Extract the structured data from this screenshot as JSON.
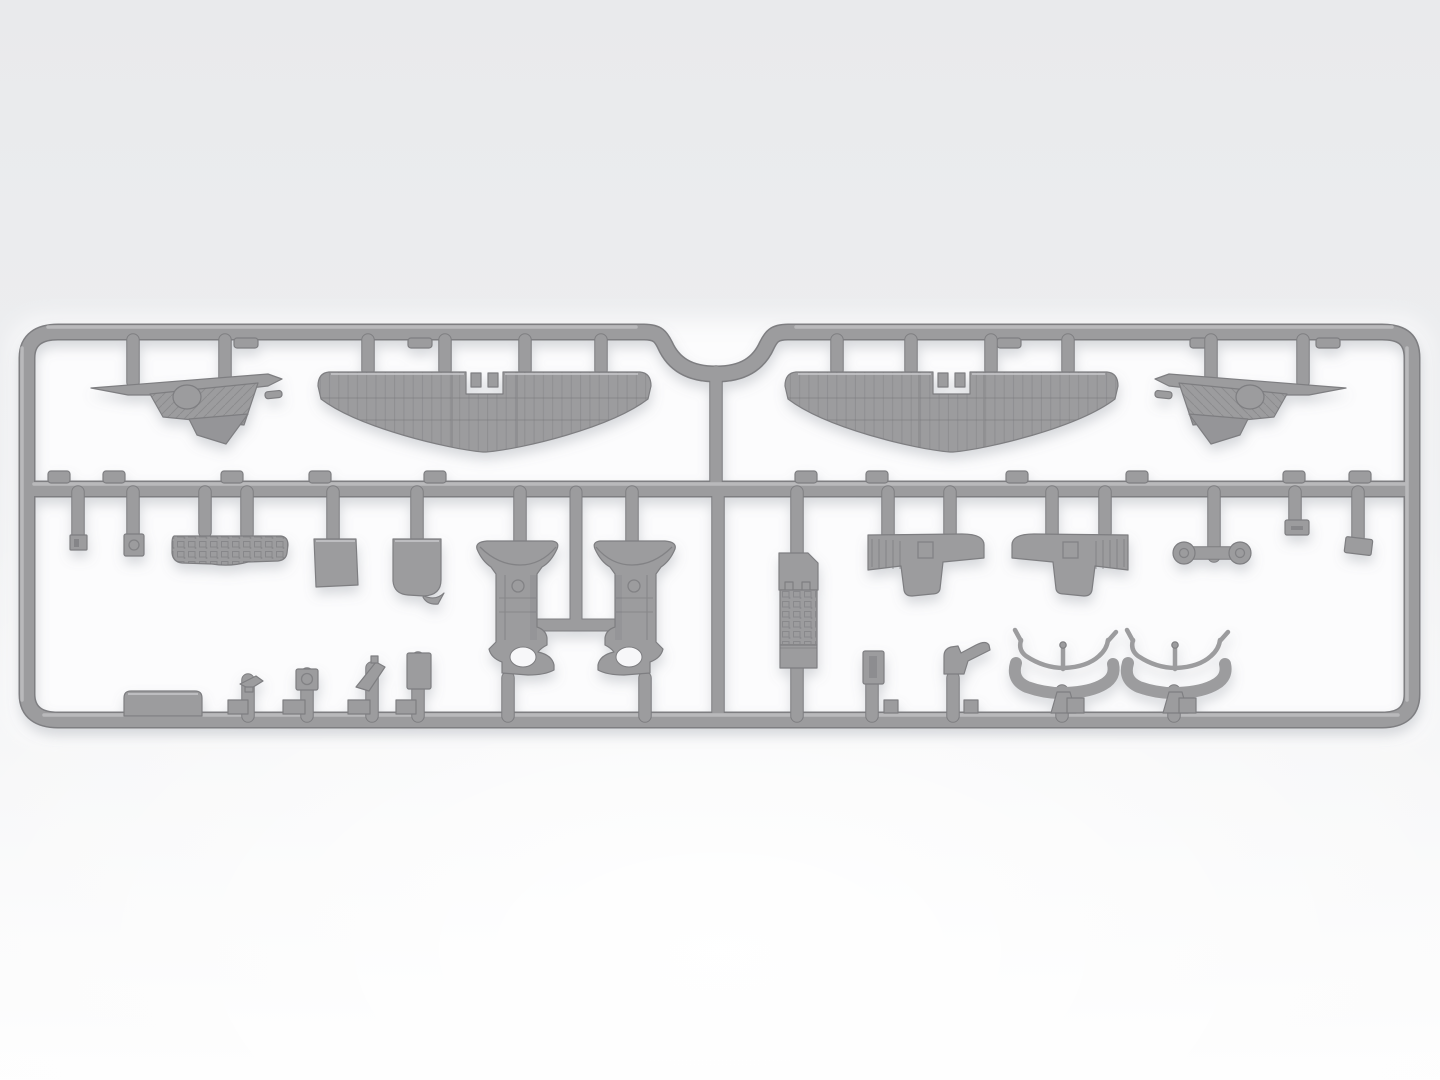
{
  "scene": {
    "type": "product-render",
    "subject": "Gray injection-molded plastic sprue (parts frame) of a scale model aircraft kit, viewed top-down",
    "background": "soft light-gray studio gradient, brighter toward the bottom",
    "text_content": "none"
  },
  "colors": {
    "plastic": "#9c9c9e",
    "plasticDark": "#7e7e81",
    "plasticLight": "#c6c6c8",
    "detailDark": "#77777a",
    "holeFill": "#f7f7f9",
    "innerGlow": "#fcfcfd",
    "bgTop": "#e9eaec",
    "bgMid": "#edeef0",
    "bgBottom": "#fdfdfd",
    "shadow": "#7e8490"
  },
  "sprue": {
    "shape": "wide rounded-rectangle frame with a semicircular notch at top center, one horizontal middle rail, and a vertical center divider",
    "rows": 2,
    "halves": 2,
    "attachment_stubs": {
      "top_rail": 12,
      "middle_rail": 16,
      "bottom_rail": 11
    }
  },
  "parts": [
    {
      "name": "stabilizer-half-left",
      "description": "Tailplane/elevator half with ribbed surface and round balance bump",
      "area": "top row, far left"
    },
    {
      "name": "lower-wing-left",
      "description": "One-piece corrugated lower wing with central fuselage notch",
      "area": "top row, left of center"
    },
    {
      "name": "lower-wing-right",
      "description": "Mirrored one-piece corrugated lower wing with central fuselage notch",
      "area": "top row, right of center"
    },
    {
      "name": "stabilizer-half-right",
      "description": "Mirrored tailplane/elevator half",
      "area": "top row, far right"
    },
    {
      "name": "small-fitting-plate",
      "description": "Tiny square fitting with slot",
      "area": "middle row, far left"
    },
    {
      "name": "bracket-with-hole",
      "description": "Small rectangular bracket with round opening",
      "area": "middle row, left"
    },
    {
      "name": "instrument-panel",
      "description": "Long cockpit instrument panel with engraved dial detail",
      "area": "middle row, left"
    },
    {
      "name": "access-hatch-plate",
      "description": "Flat square hatch plate",
      "area": "middle row, left-center"
    },
    {
      "name": "seat-back-plate",
      "description": "Plate with rounded lower corners",
      "area": "middle row, left-center"
    },
    {
      "name": "cowling-half-left",
      "description": "Engine cowling/fuselage half with flared lip, panel lines and round cut-out",
      "area": "middle row, center pair"
    },
    {
      "name": "cowling-half-right",
      "description": "Mirrored engine cowling/fuselage half",
      "area": "middle row, center pair"
    },
    {
      "name": "engine-block",
      "description": "Tall engine block with finned center section",
      "area": "middle row, right half"
    },
    {
      "name": "fuselage-side-panel-left",
      "description": "Stepped side panel with louver grooves",
      "area": "middle row, right half"
    },
    {
      "name": "fuselage-side-panel-right",
      "description": "Mirrored stepped side panel with louver grooves",
      "area": "middle row, right half"
    },
    {
      "name": "wheel-pair",
      "description": "Two main wheels on a T-shaped runner",
      "area": "middle row, far right"
    },
    {
      "name": "small-clamp-block",
      "description": "Small rectangular block with slot",
      "area": "middle row, far right"
    },
    {
      "name": "small-wedge-block",
      "description": "Small tilted rectangular block",
      "area": "middle row, far right"
    },
    {
      "name": "equipment-box",
      "description": "Long low box with rounded top corners",
      "area": "bottom row, far left"
    },
    {
      "name": "tiny-fitting-a",
      "description": "Very small clip-like fitting",
      "area": "bottom row, left"
    },
    {
      "name": "tiny-fitting-b",
      "description": "Small square fitting with round boss",
      "area": "bottom row, left"
    },
    {
      "name": "tiny-fitting-c",
      "description": "Small angled blade fitting",
      "area": "bottom row, left"
    },
    {
      "name": "tiny-fitting-d",
      "description": "Small rectangular plate",
      "area": "bottom row, left-center"
    },
    {
      "name": "side-hatch-plate",
      "description": "Small plate with rectangular slot",
      "area": "bottom row, right half"
    },
    {
      "name": "support-hook",
      "description": "Curved hook/boot-shaped support",
      "area": "bottom row, right half"
    },
    {
      "name": "float-left",
      "description": "Sled-shaped float/ski with upturned tips, upper rail and center post",
      "area": "bottom row, right"
    },
    {
      "name": "float-right",
      "description": "Second sled-shaped float/ski",
      "area": "bottom row, right"
    }
  ]
}
